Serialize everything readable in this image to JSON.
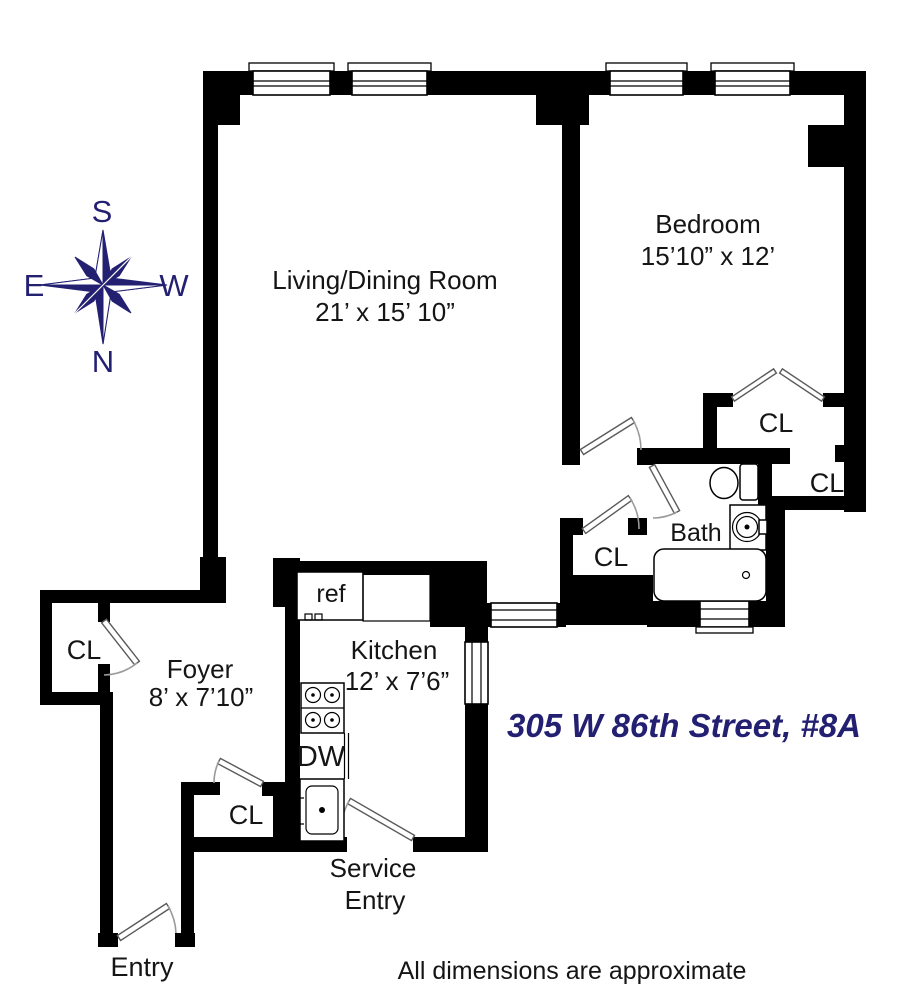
{
  "title": "305 W 86th Street, #8A",
  "disclaimer": "All dimensions are approximate",
  "colors": {
    "walls": "#000000",
    "accent": "#232072",
    "door": "#5a5a5a",
    "arc": "#9a9a9a"
  },
  "compass": {
    "top": "S",
    "left": "E",
    "right": "W",
    "bottom": "N"
  },
  "rooms": {
    "living": {
      "name": "Living/Dining Room",
      "dims": "21’ x 15’ 10”"
    },
    "bedroom": {
      "name": "Bedroom",
      "dims": "15’10” x 12’"
    },
    "kitchen": {
      "name": "Kitchen",
      "dims": "12’ x 7’6”"
    },
    "foyer": {
      "name": "Foyer",
      "dims": "8’ x 7’10”"
    },
    "bath": {
      "name": "Bath"
    }
  },
  "closets": {
    "foyer": "CL",
    "hall": "CL",
    "bedroom": "CL",
    "bedroom2": "CL",
    "service": "CL"
  },
  "fixtures": {
    "refrigerator": "ref",
    "dishwasher": "DW"
  },
  "entries": {
    "service_line1": "Service",
    "service_line2": "Entry",
    "main": "Entry"
  }
}
